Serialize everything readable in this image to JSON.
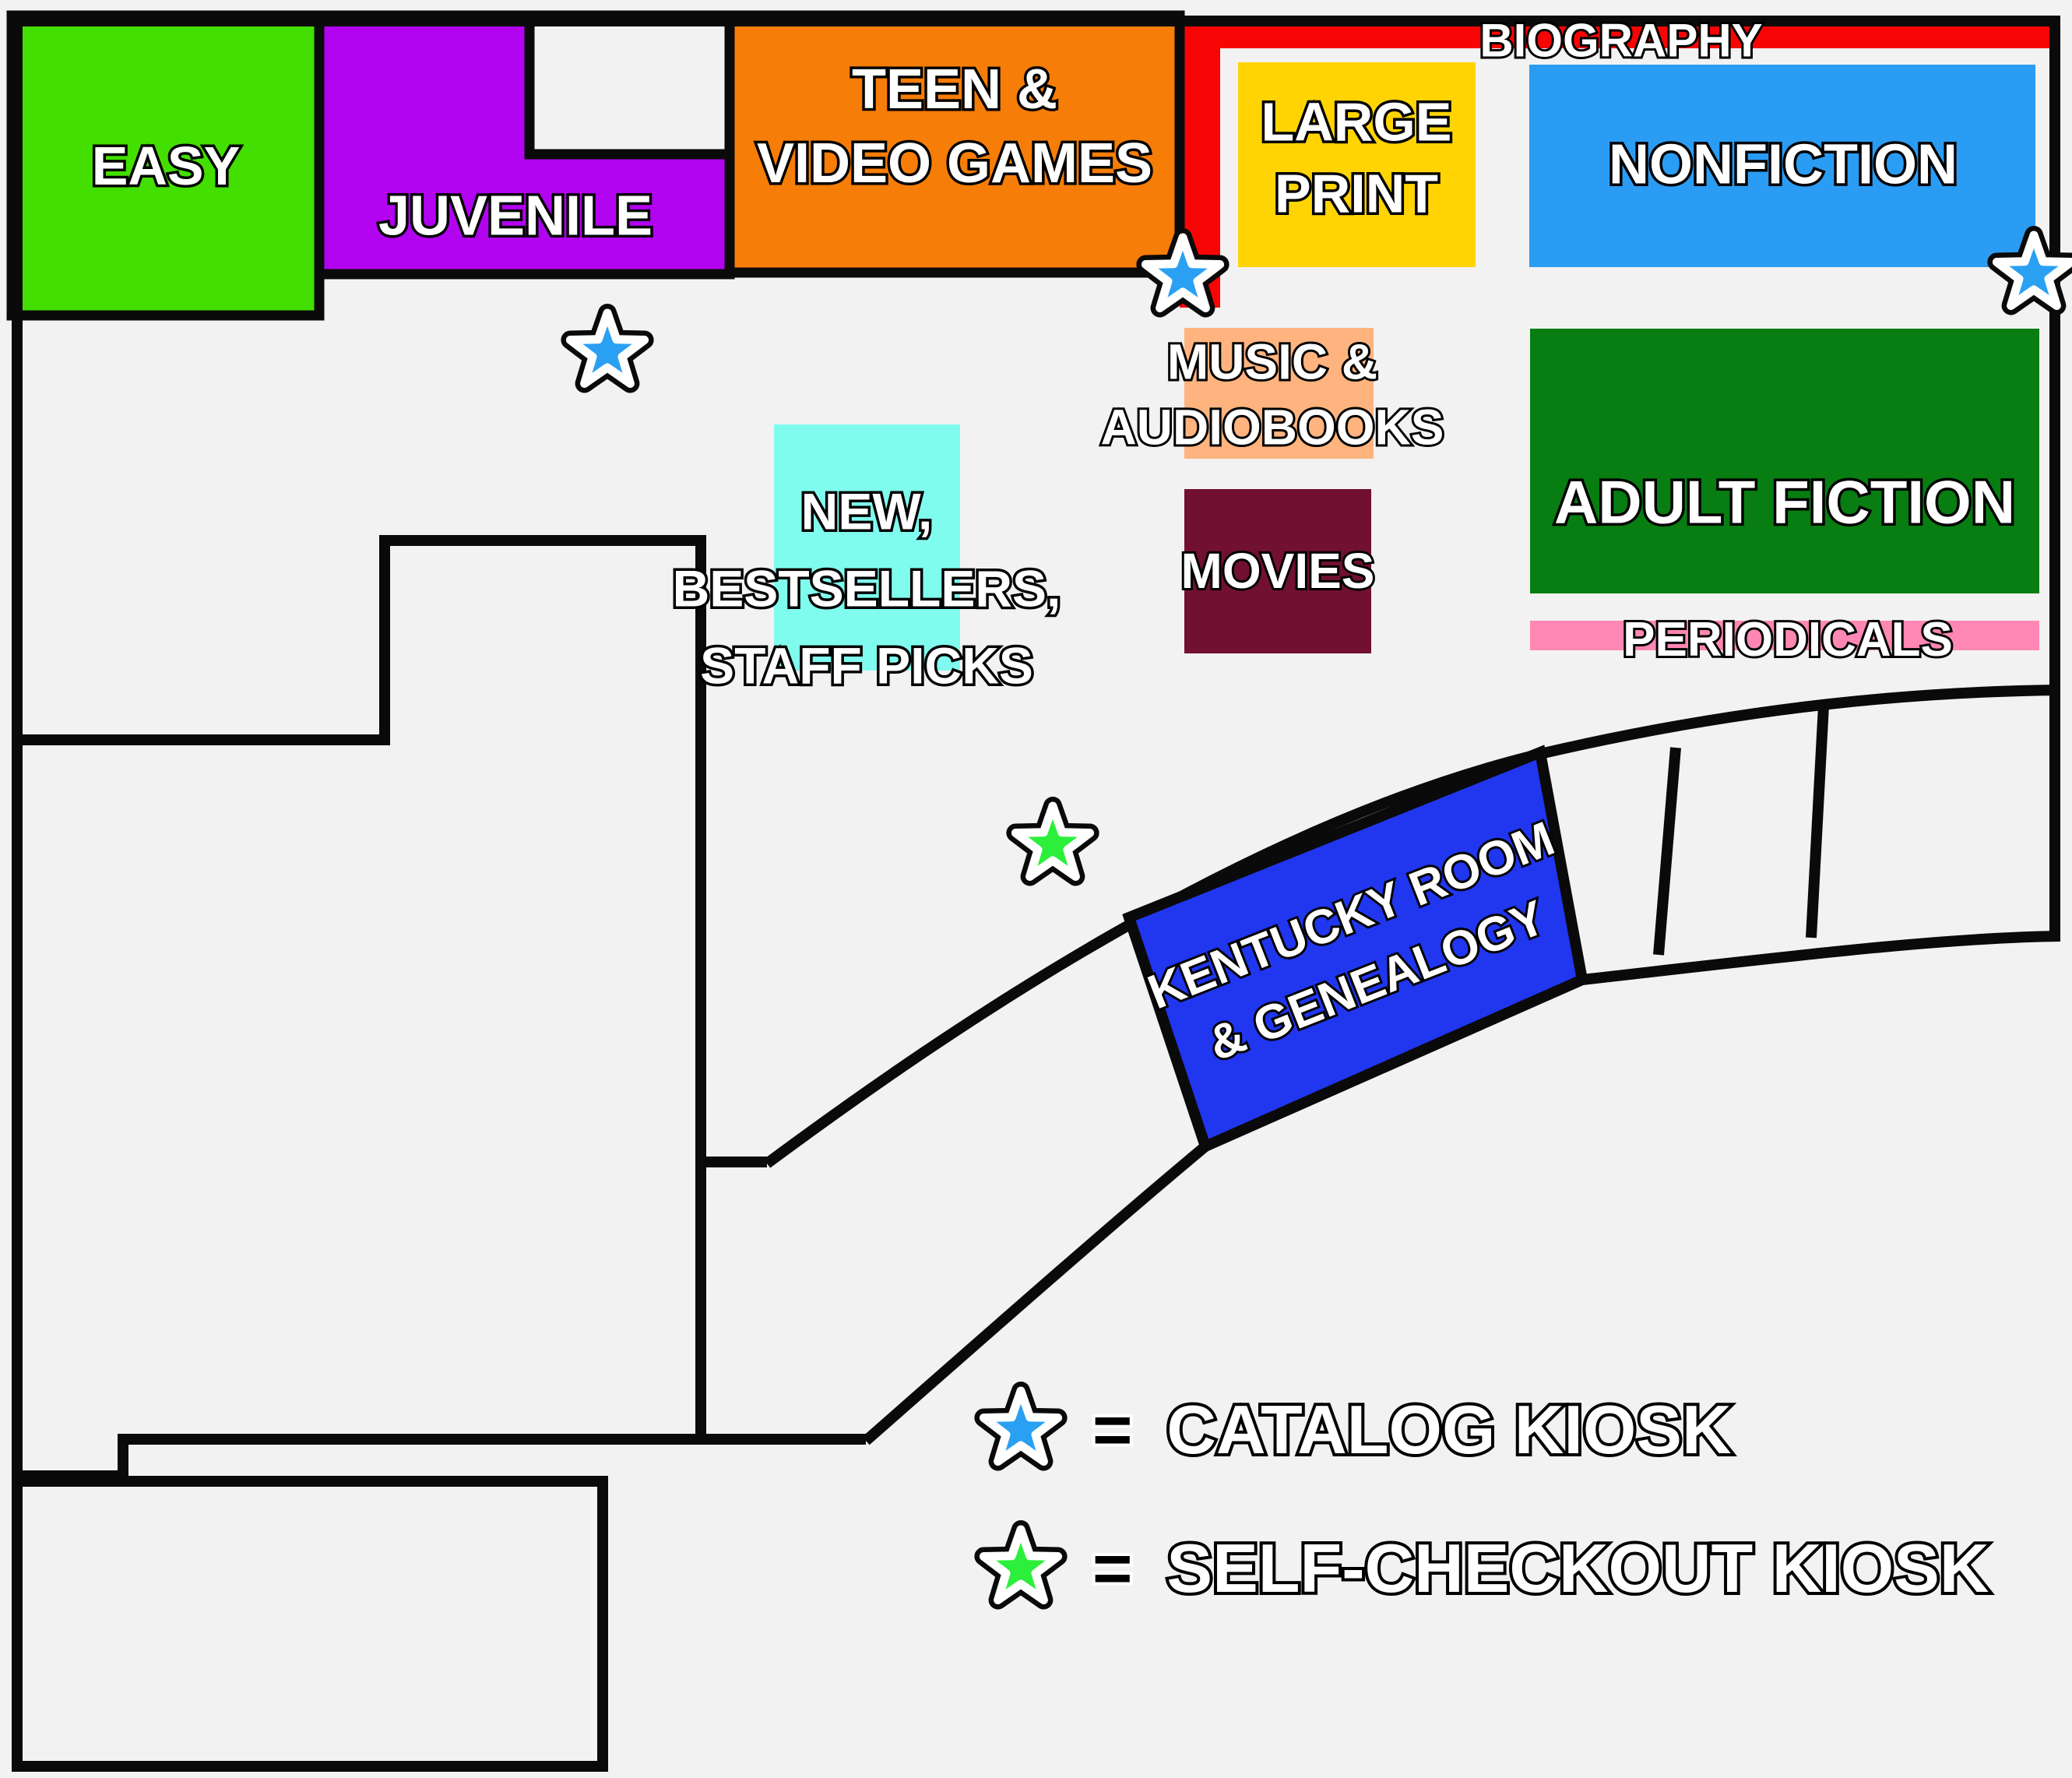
{
  "map": {
    "background_color": "#f2f2f2",
    "wall_color": "#0a0a0a",
    "regions": {
      "easy": {
        "label": "EASY",
        "color": "#43df00"
      },
      "juvenile": {
        "label": "JUVENILE",
        "color": "#b203f0"
      },
      "teen": {
        "line1": "TEEN &",
        "line2": "VIDEO GAMES",
        "color": "#f67d07"
      },
      "biography": {
        "label": "BIOGRAPHY",
        "color": "#f70505"
      },
      "large_print": {
        "line1": "LARGE",
        "line2": "PRINT",
        "color": "#ffd402"
      },
      "nonfiction": {
        "label": "NONFICTION",
        "color": "#2b9cf4"
      },
      "music_audiobooks": {
        "line1": "MUSIC &",
        "line2": "AUDIOBOOKS",
        "color": "#ffb37e"
      },
      "new_bestsellers": {
        "line1": "NEW,",
        "line2": "BESTSELLERS,",
        "line3": "STAFF PICKS",
        "color": "#80fcee"
      },
      "movies": {
        "label": "MOVIES",
        "color": "#711031"
      },
      "adult_fiction": {
        "label": "ADULT FICTION",
        "color": "#077d12"
      },
      "periodicals": {
        "label": "PERIODICALS",
        "color": "#ff87b4"
      },
      "kentucky_room": {
        "line1": "KENTUCKY ROOM",
        "line2": "& GENEALOGY",
        "color": "#2136ef"
      }
    },
    "kiosks": {
      "catalog": {
        "color": "#2aa0f3",
        "points": [
          [
            780,
            452
          ],
          [
            1519,
            355
          ],
          [
            2612,
            352
          ]
        ]
      },
      "self_checkout": {
        "color": "#2cef3b",
        "points": [
          [
            1352,
            1085
          ]
        ]
      }
    }
  },
  "legend": {
    "items": [
      {
        "eq": "=",
        "label": "CATALOG KIOSK"
      },
      {
        "eq": "=",
        "label": "SELF-CHECKOUT KIOSK"
      }
    ]
  }
}
